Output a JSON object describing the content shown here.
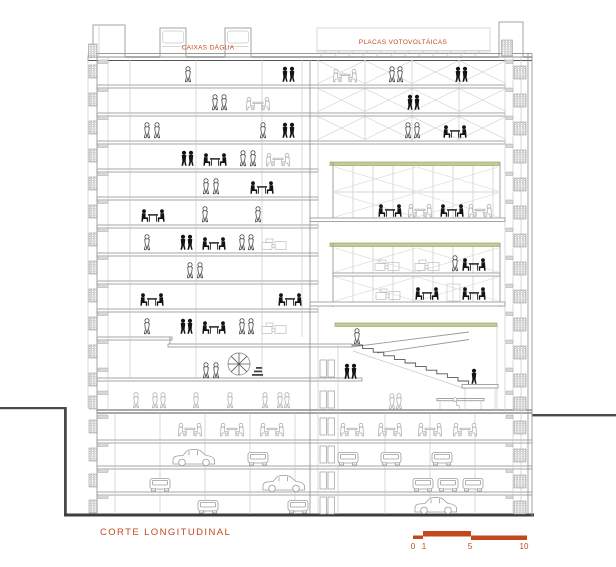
{
  "drawing": {
    "title": "CORTE LONGITUDINAL",
    "annotations": {
      "water_tanks": "CAIXAS DÁGUA",
      "pv_panels": "PLACAS VOTOVOLTÁICAS"
    },
    "scale_bar": {
      "ticks": [
        "0",
        "1",
        "5",
        "10"
      ]
    },
    "colors": {
      "annotation_orange": "#c2491c",
      "green_roof": "#c3cc96",
      "line_dark": "#4a4a4a",
      "line_medium": "#9a9a9a",
      "line_light": "#c8c8c8",
      "figure_dark": "#141414"
    },
    "structure": {
      "office_floors": 10,
      "atrium_garden_terraces": 3,
      "basement_parking_levels": 3
    }
  }
}
